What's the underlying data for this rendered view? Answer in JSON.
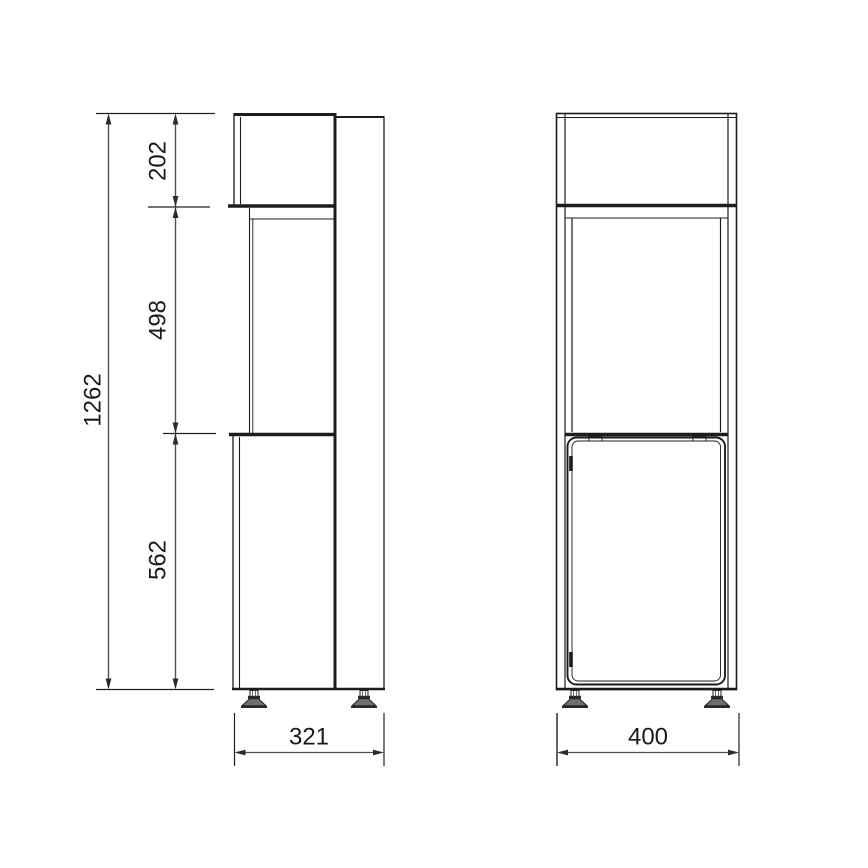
{
  "drawing": {
    "type": "technical-dimension-drawing",
    "subject": "tall cabinet with upper box, open middle display section and bottom door, on adjustable leveling feet",
    "views": [
      {
        "id": "side",
        "label": "side view"
      },
      {
        "id": "front",
        "label": "front view"
      }
    ],
    "dimensions": {
      "overall_height": "1262",
      "top_section_height": "202",
      "middle_section_height": "498",
      "bottom_section_height": "562",
      "side_depth": "321",
      "front_width": "400"
    },
    "colors": {
      "background": "#ffffff",
      "object_line": "#1c1c1c",
      "dimension_line": "#4f4f4f",
      "arrow": "#2b2b2b",
      "text": "#1a1a1a"
    }
  }
}
